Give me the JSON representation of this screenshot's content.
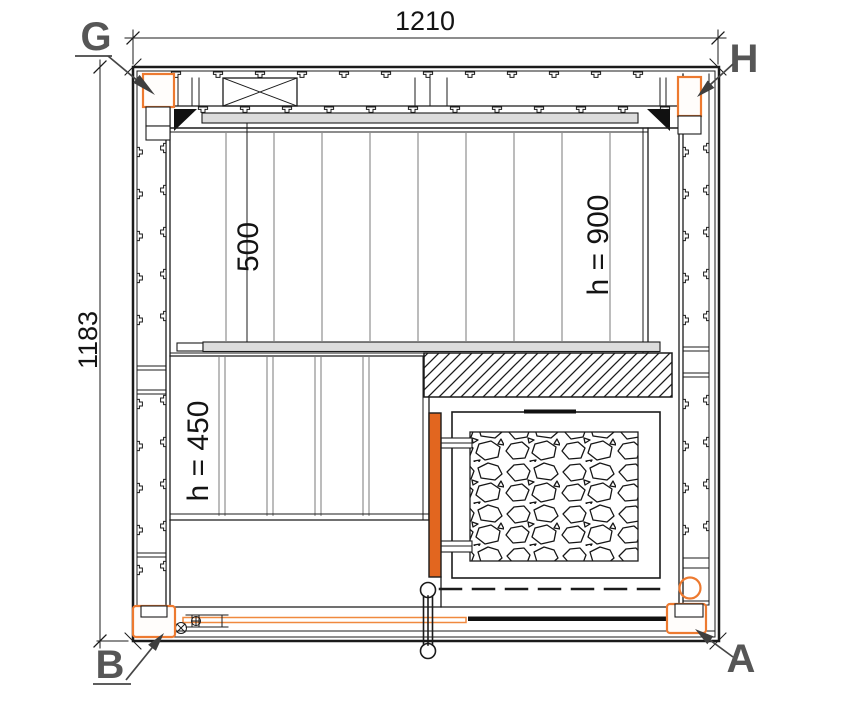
{
  "drawing": {
    "dim_width": "1210",
    "dim_height": "1183",
    "dim_bench_depth": "500",
    "label_bench_right": "h = 900",
    "label_bench_left": "h = 450",
    "corner_top_left": "G",
    "corner_top_right": "H",
    "corner_bottom_left": "B",
    "corner_bottom_right": "A"
  },
  "colors": {
    "outline": "#1b1b1b",
    "highlight_stroke": "#ed7a30",
    "highlight_fill": "#e2661f",
    "board_gray": "#dcdcdc",
    "slat_gray": "#8f8f8f",
    "label_gray": "#565656"
  }
}
